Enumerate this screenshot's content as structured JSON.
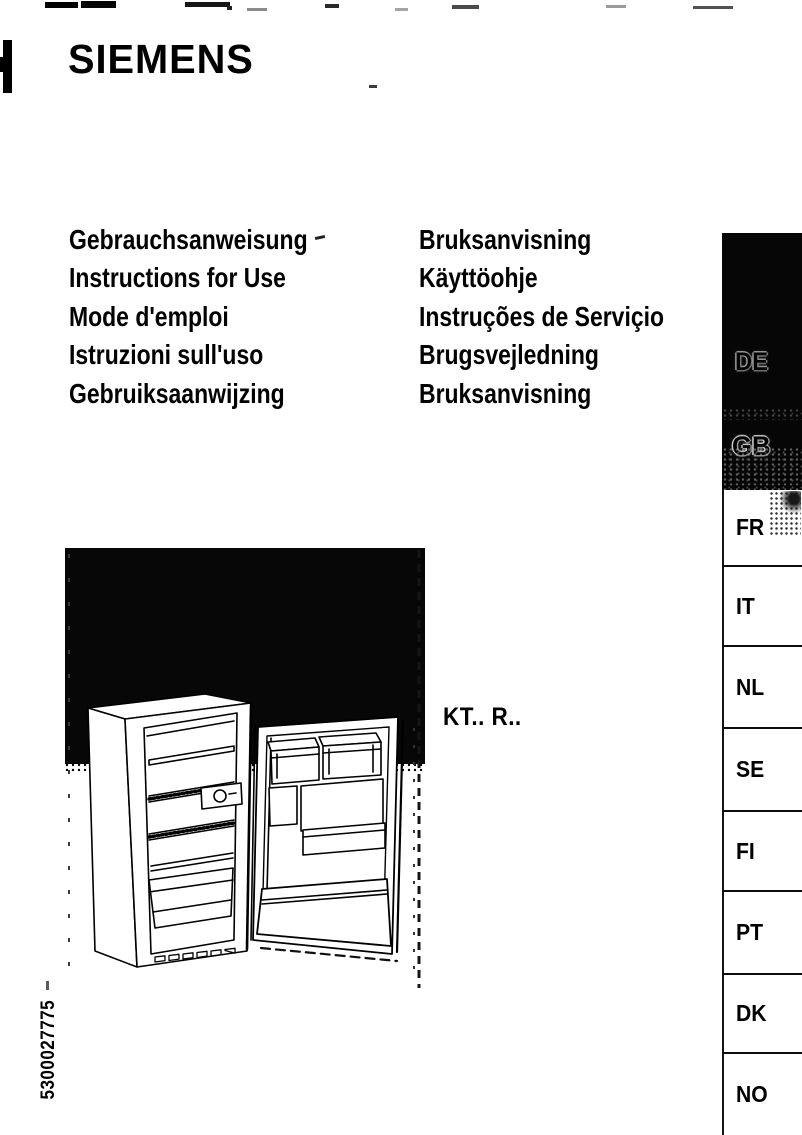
{
  "brand": "SIEMENS",
  "doc_titles": {
    "left": [
      "Gebrauchsanweisung",
      "Instructions for Use",
      "Mode d'emploi",
      "Istruzioni sull'uso",
      "Gebruiksaanwijzing"
    ],
    "right": [
      "Bruksanvisning",
      "Käyttöohje",
      "Instruções de Serviçio",
      "Brugsvejledning",
      "Bruksanvisning"
    ]
  },
  "model_code": "KT.. R..",
  "part_number": "5300027775",
  "sidebar": {
    "dark_tabs": [
      {
        "code": "DE"
      },
      {
        "code": "GB"
      }
    ],
    "tabs": [
      {
        "code": "FR"
      },
      {
        "code": "IT"
      },
      {
        "code": "NL"
      },
      {
        "code": "SE"
      },
      {
        "code": "FI"
      },
      {
        "code": "PT"
      },
      {
        "code": "DK"
      },
      {
        "code": "NO"
      }
    ]
  },
  "colors": {
    "ink": "#000000",
    "paper": "#ffffff",
    "ghost_outline": "#cfcfcf"
  }
}
